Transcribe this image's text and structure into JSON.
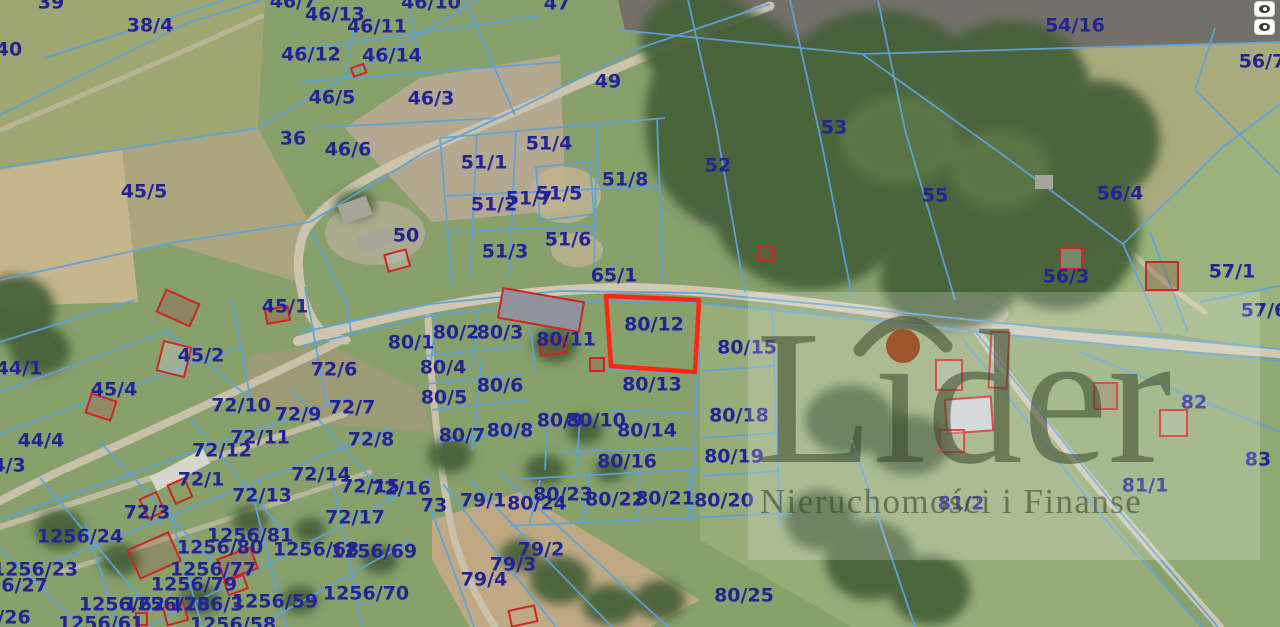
{
  "watermark": {
    "brand": "Lider",
    "tagline": "Nieruchomości i Finanse"
  },
  "highlighted_parcel": {
    "number": "80/12"
  },
  "colors": {
    "boundary": "#5fa2d9",
    "label": "#232394",
    "highlight": "#ff2713",
    "building": "#cf2522",
    "watermark_text": "rgba(56,68,40,0.55)",
    "watermark_dot": "#9c3e14"
  },
  "controls": {
    "buttons": [
      {
        "name": "layer-toggle-top",
        "icon": "eye-icon"
      },
      {
        "name": "layer-toggle-bottom",
        "icon": "eye-icon"
      }
    ]
  },
  "parcel_labels": [
    {
      "t": "39",
      "x": 51,
      "y": 3
    },
    {
      "t": "38/4",
      "x": 150,
      "y": 26
    },
    {
      "t": "40",
      "x": 9,
      "y": 50
    },
    {
      "t": "46/7",
      "x": 293,
      "y": 2
    },
    {
      "t": "46/13",
      "x": 335,
      "y": 15
    },
    {
      "t": "46/11",
      "x": 377,
      "y": 27
    },
    {
      "t": "46/10",
      "x": 431,
      "y": 3
    },
    {
      "t": "47",
      "x": 557,
      "y": 4
    },
    {
      "t": "46/12",
      "x": 311,
      "y": 55
    },
    {
      "t": "46/14",
      "x": 392,
      "y": 56
    },
    {
      "t": "46/5",
      "x": 332,
      "y": 98
    },
    {
      "t": "46/3",
      "x": 431,
      "y": 99
    },
    {
      "t": "49",
      "x": 608,
      "y": 82
    },
    {
      "t": "36",
      "x": 293,
      "y": 139
    },
    {
      "t": "46/6",
      "x": 348,
      "y": 150
    },
    {
      "t": "45/5",
      "x": 144,
      "y": 192
    },
    {
      "t": "54/16",
      "x": 1075,
      "y": 26
    },
    {
      "t": "56/7",
      "x": 1262,
      "y": 62
    },
    {
      "t": "53",
      "x": 834,
      "y": 128
    },
    {
      "t": "52",
      "x": 718,
      "y": 166
    },
    {
      "t": "55",
      "x": 935,
      "y": 196
    },
    {
      "t": "56/4",
      "x": 1120,
      "y": 194
    },
    {
      "t": "51/4",
      "x": 549,
      "y": 144
    },
    {
      "t": "51/1",
      "x": 484,
      "y": 163
    },
    {
      "t": "51/8",
      "x": 625,
      "y": 180
    },
    {
      "t": "51/5",
      "x": 559,
      "y": 194
    },
    {
      "t": "51/7",
      "x": 529,
      "y": 199
    },
    {
      "t": "51/2",
      "x": 494,
      "y": 205
    },
    {
      "t": "51/6",
      "x": 568,
      "y": 240
    },
    {
      "t": "51/3",
      "x": 505,
      "y": 252
    },
    {
      "t": "65/1",
      "x": 614,
      "y": 276
    },
    {
      "t": "56/3",
      "x": 1066,
      "y": 277
    },
    {
      "t": "57/1",
      "x": 1232,
      "y": 272
    },
    {
      "t": "57/6",
      "x": 1264,
      "y": 311
    },
    {
      "t": "50",
      "x": 406,
      "y": 236
    },
    {
      "t": "45/1",
      "x": 285,
      "y": 307
    },
    {
      "t": "44/1",
      "x": 19,
      "y": 369
    },
    {
      "t": "45/2",
      "x": 201,
      "y": 356
    },
    {
      "t": "45/4",
      "x": 114,
      "y": 390
    },
    {
      "t": "80/1",
      "x": 411,
      "y": 343
    },
    {
      "t": "80/2",
      "x": 456,
      "y": 333
    },
    {
      "t": "80/3",
      "x": 500,
      "y": 333
    },
    {
      "t": "80/11",
      "x": 566,
      "y": 340
    },
    {
      "t": "80/12",
      "x": 654,
      "y": 325
    },
    {
      "t": "80/15",
      "x": 747,
      "y": 348
    },
    {
      "t": "80/4",
      "x": 443,
      "y": 368
    },
    {
      "t": "72/6",
      "x": 334,
      "y": 370
    },
    {
      "t": "80/6",
      "x": 500,
      "y": 386
    },
    {
      "t": "80/5",
      "x": 444,
      "y": 398
    },
    {
      "t": "80/13",
      "x": 652,
      "y": 385
    },
    {
      "t": "72/10",
      "x": 241,
      "y": 406
    },
    {
      "t": "72/9",
      "x": 298,
      "y": 415
    },
    {
      "t": "72/7",
      "x": 352,
      "y": 408
    },
    {
      "t": "82",
      "x": 1194,
      "y": 403
    },
    {
      "t": "80/18",
      "x": 739,
      "y": 416
    },
    {
      "t": "80/9",
      "x": 560,
      "y": 421
    },
    {
      "t": "80/10",
      "x": 596,
      "y": 421
    },
    {
      "t": "80/14",
      "x": 647,
      "y": 431
    },
    {
      "t": "80/8",
      "x": 510,
      "y": 431
    },
    {
      "t": "72/11",
      "x": 260,
      "y": 438
    },
    {
      "t": "72/12",
      "x": 222,
      "y": 451
    },
    {
      "t": "72/8",
      "x": 371,
      "y": 440
    },
    {
      "t": "80/7",
      "x": 462,
      "y": 436
    },
    {
      "t": "44/4",
      "x": 41,
      "y": 441
    },
    {
      "t": "80/16",
      "x": 627,
      "y": 462
    },
    {
      "t": "80/19",
      "x": 734,
      "y": 457
    },
    {
      "t": "83",
      "x": 1258,
      "y": 460
    },
    {
      "t": "4/3",
      "x": 9,
      "y": 466
    },
    {
      "t": "72/14",
      "x": 321,
      "y": 475
    },
    {
      "t": "72/1",
      "x": 201,
      "y": 480
    },
    {
      "t": "81/1",
      "x": 1145,
      "y": 486
    },
    {
      "t": "72/15",
      "x": 370,
      "y": 487
    },
    {
      "t": "72/16",
      "x": 401,
      "y": 489
    },
    {
      "t": "80/23",
      "x": 563,
      "y": 495
    },
    {
      "t": "72/13",
      "x": 262,
      "y": 496
    },
    {
      "t": "79/1",
      "x": 483,
      "y": 501
    },
    {
      "t": "80/22",
      "x": 615,
      "y": 500
    },
    {
      "t": "80/21",
      "x": 665,
      "y": 499
    },
    {
      "t": "80/20",
      "x": 724,
      "y": 501
    },
    {
      "t": "80/24",
      "x": 537,
      "y": 504
    },
    {
      "t": "81/2",
      "x": 961,
      "y": 504
    },
    {
      "t": "73",
      "x": 434,
      "y": 506
    },
    {
      "t": "72/3",
      "x": 147,
      "y": 513
    },
    {
      "t": "72/17",
      "x": 355,
      "y": 518
    },
    {
      "t": "1256/24",
      "x": 80,
      "y": 537
    },
    {
      "t": "1256/81",
      "x": 250,
      "y": 536
    },
    {
      "t": "1256/80",
      "x": 220,
      "y": 548
    },
    {
      "t": "79/2",
      "x": 541,
      "y": 550
    },
    {
      "t": "1256/68",
      "x": 316,
      "y": 550
    },
    {
      "t": "1256/69",
      "x": 374,
      "y": 552
    },
    {
      "t": "79/3",
      "x": 513,
      "y": 565
    },
    {
      "t": "1256/23",
      "x": 35,
      "y": 570
    },
    {
      "t": "1256/77",
      "x": 213,
      "y": 570
    },
    {
      "t": "79/4",
      "x": 484,
      "y": 580
    },
    {
      "t": "1256/79",
      "x": 194,
      "y": 585
    },
    {
      "t": "56/27",
      "x": 18,
      "y": 586
    },
    {
      "t": "80/25",
      "x": 744,
      "y": 596
    },
    {
      "t": "1256/70",
      "x": 366,
      "y": 594
    },
    {
      "t": "1256/62",
      "x": 122,
      "y": 605
    },
    {
      "t": "1256/78",
      "x": 167,
      "y": 605
    },
    {
      "t": "1256/3",
      "x": 207,
      "y": 605
    },
    {
      "t": "1256/59",
      "x": 275,
      "y": 602
    },
    {
      "t": "/26",
      "x": 14,
      "y": 618
    },
    {
      "t": "1256/61",
      "x": 101,
      "y": 624
    },
    {
      "t": "1256/58",
      "x": 233,
      "y": 625
    }
  ]
}
